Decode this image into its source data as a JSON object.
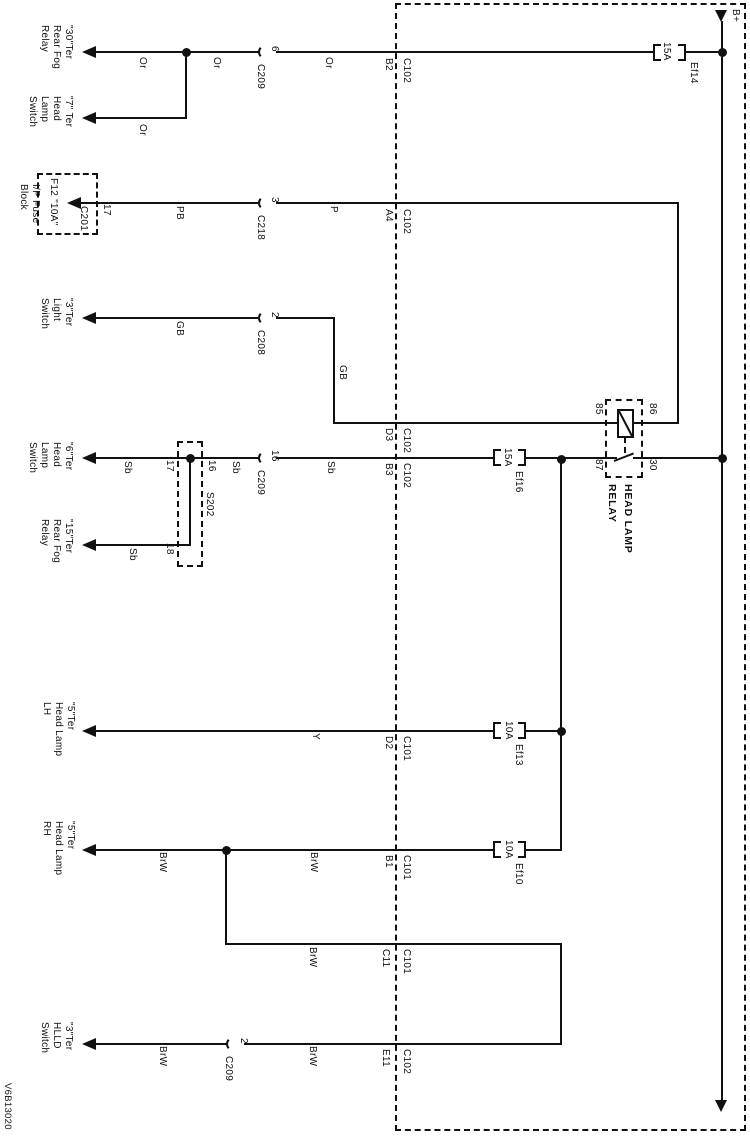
{
  "diagram_id": "V6B13020",
  "power_label": "B+",
  "colors": {
    "line": "#111111",
    "background": "#ffffff"
  },
  "relay": {
    "name": "HEAD LAMP\nRELAY",
    "pin_85": "85",
    "pin_86": "86",
    "pin_87": "87",
    "pin_30": "30"
  },
  "fuses": {
    "ef14": {
      "name": "Ef14",
      "rating": "15A"
    },
    "ef16": {
      "name": "Ef16",
      "rating": "15A"
    },
    "ef13": {
      "name": "Ef13",
      "rating": "10A"
    },
    "ef10": {
      "name": "Ef10",
      "rating": "10A"
    }
  },
  "fuse_block": {
    "label": "I/P Fuse\nBlock",
    "fuse": "F12 \"10A\"",
    "connector": "C201",
    "pin": "17"
  },
  "splice": {
    "name": "S202",
    "pin_16": "16",
    "pin_17": "17",
    "pin_18": "18"
  },
  "connectors": {
    "c209": "C209",
    "c218": "C218",
    "c208": "C208",
    "c102": "C102",
    "c101": "C101",
    "pins": {
      "p6": "6",
      "p3": "3",
      "p2": "2",
      "p16": "16",
      "b2": "B2",
      "a4": "A4",
      "d3": "D3",
      "b3": "B3",
      "d2": "D2",
      "b1": "B1",
      "c11": "C11",
      "e11": "E11"
    }
  },
  "wire_colors": {
    "or": "Or",
    "pb": "PB",
    "p": "P",
    "gb": "GB",
    "sb": "Sb",
    "y": "Y",
    "brw": "BrW"
  },
  "targets": {
    "rear_fog_relay_30": "\"30\"Ter\nRear Fog\nRelay",
    "head_lamp_switch_7": "\"7\" Ter\nHead\nLamp\nSwitch",
    "light_switch_3": "\"3\"Ter\nLight\nSwitch",
    "head_lamp_switch_6": "\"6\"Ter\nHead\nLamp\nSwitch",
    "rear_fog_relay_15": "\"15\"Ter\nRear Fog\nRelay",
    "head_lamp_lh_5": "\"5\"Ter\nHead Lamp\nLH",
    "head_lamp_rh_5": "\"5\"Ter\nHead Lamp\nRH",
    "hlld_switch_3": "\"3\"Ter\nHLLD\nSwitch"
  }
}
